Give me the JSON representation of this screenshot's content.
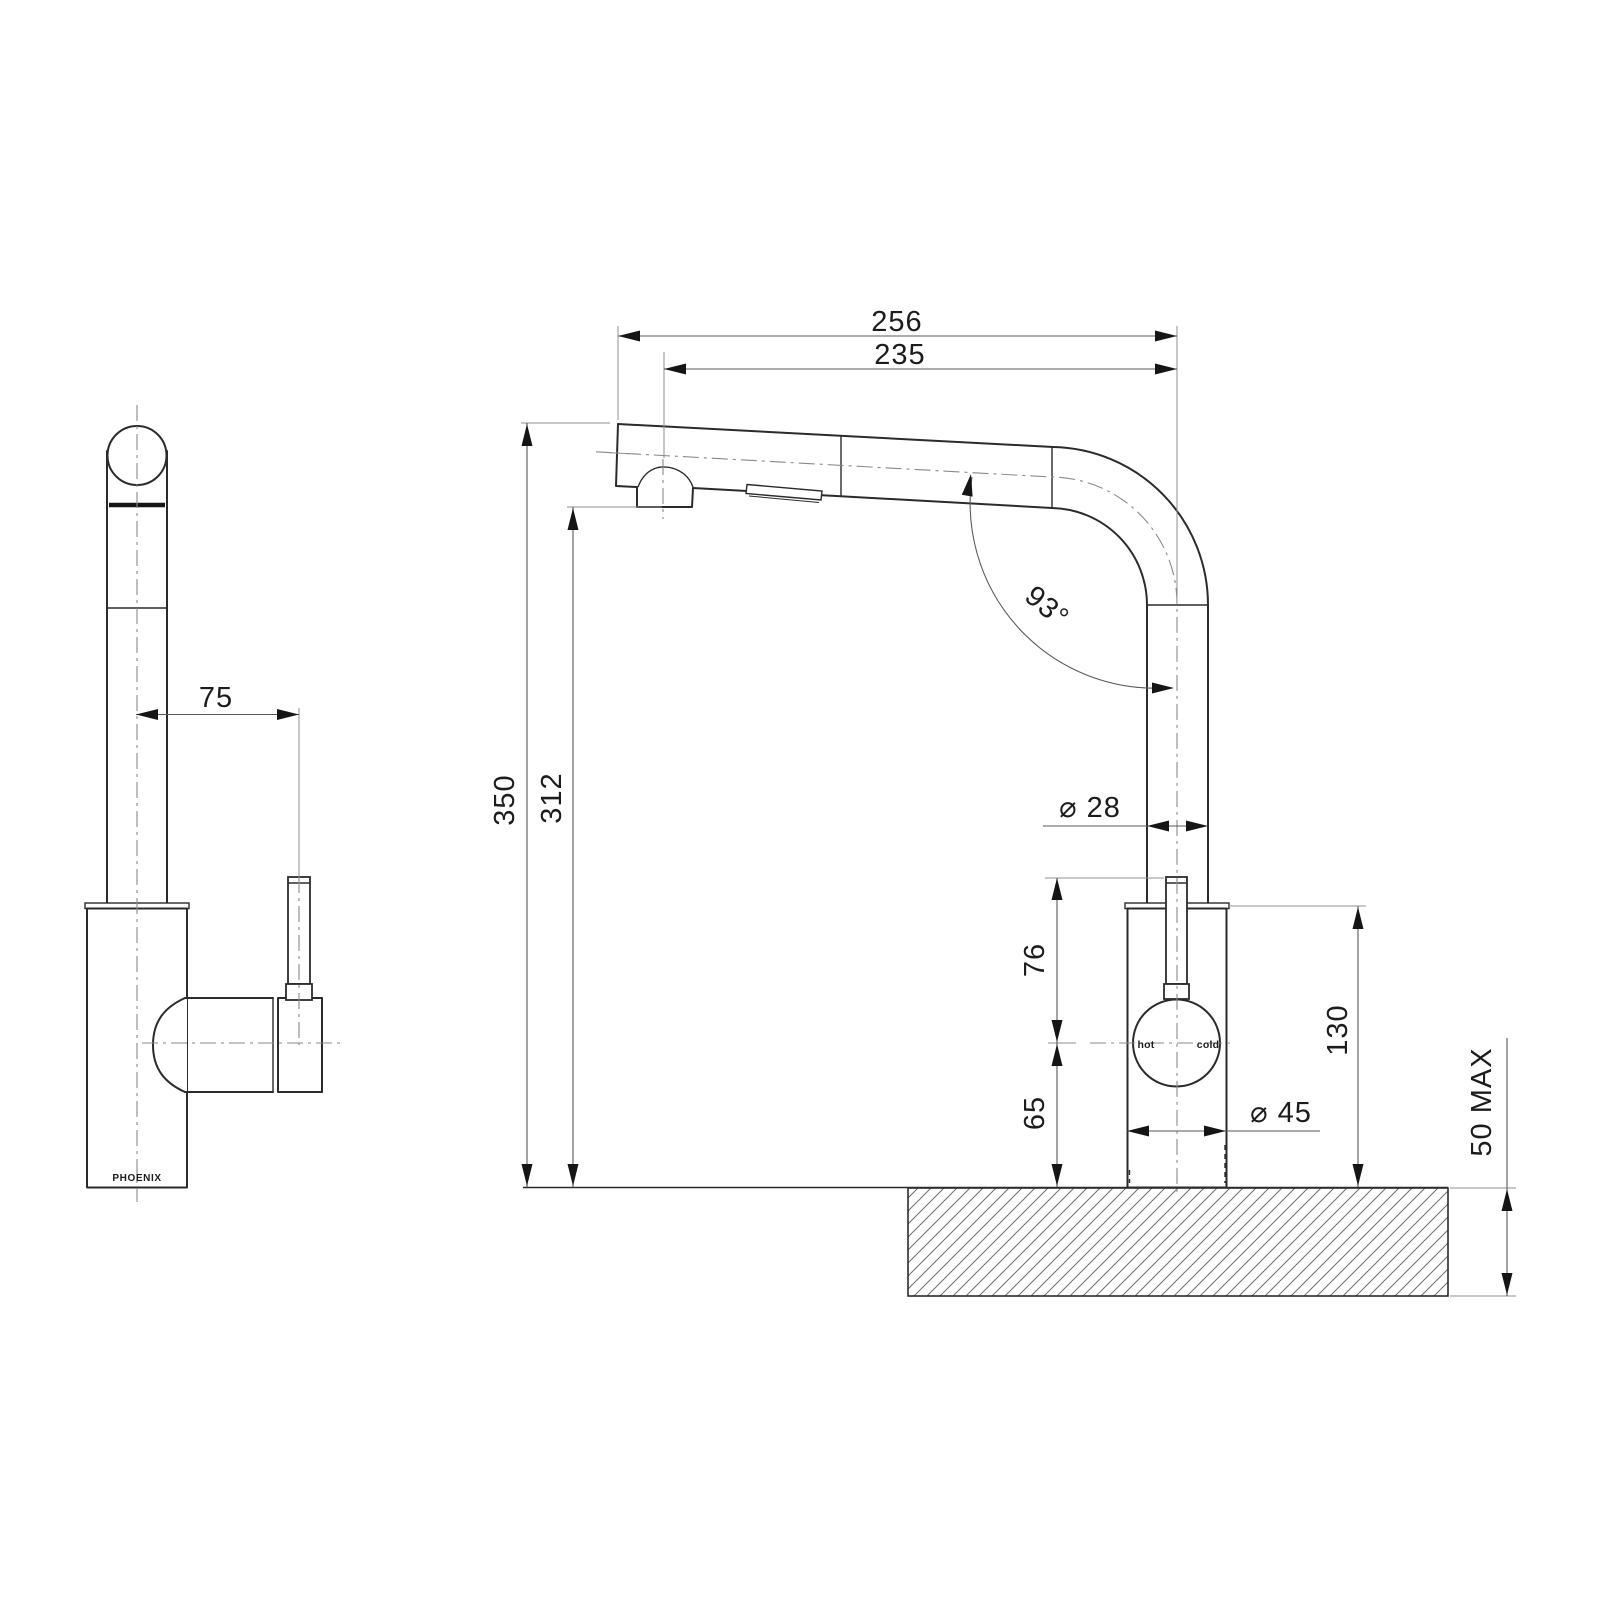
{
  "drawing": {
    "brand": "PHOENIX",
    "dial": {
      "hot": "hot",
      "cold": "cold"
    },
    "angle": {
      "spout_angle": "93°"
    },
    "dims": {
      "reach_overall": "256",
      "reach_aerator": "235",
      "handle_offset": "75",
      "height_overall": "350",
      "height_aerator": "312",
      "spout_pipe_diameter": "⌀ 28",
      "handle_above_center": "76",
      "center_above_bench": "65",
      "body_height": "130",
      "body_diameter": "⌀ 45",
      "bench_thickness_max": "50 MAX"
    }
  }
}
